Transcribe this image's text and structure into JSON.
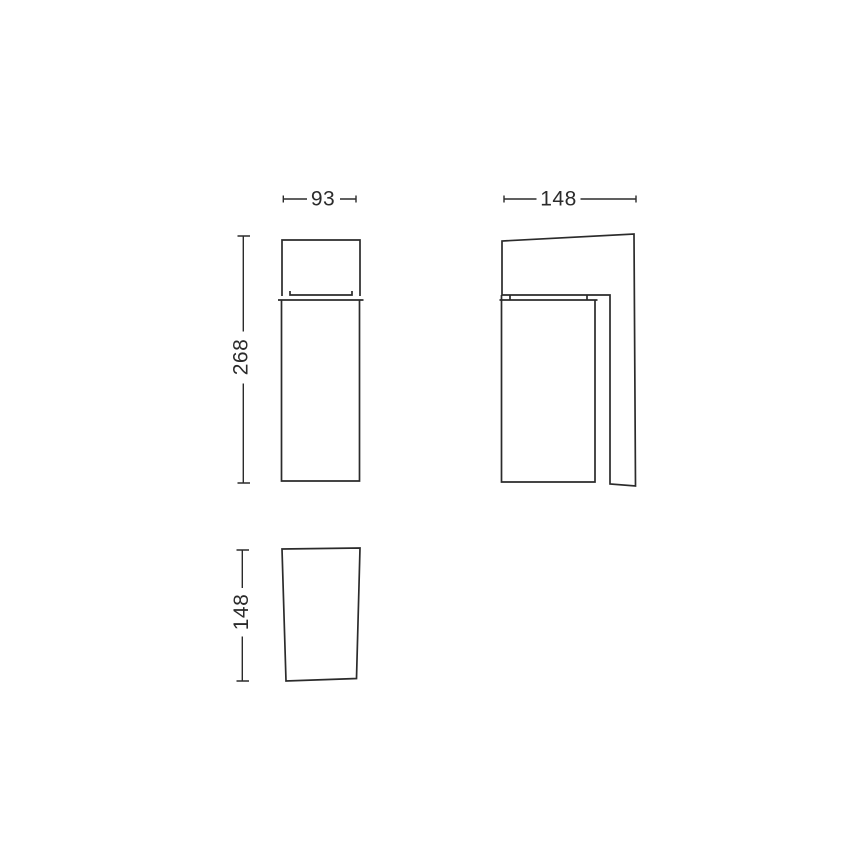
{
  "drawing": {
    "kind": "technical-dimension-drawing",
    "background_color": "#ffffff",
    "line_color": "#2b2b2b",
    "text_color": "#2b2b2b",
    "dimensions": {
      "front_width": "93",
      "front_height": "268",
      "side_width": "148",
      "bottom_depth": "148"
    }
  }
}
